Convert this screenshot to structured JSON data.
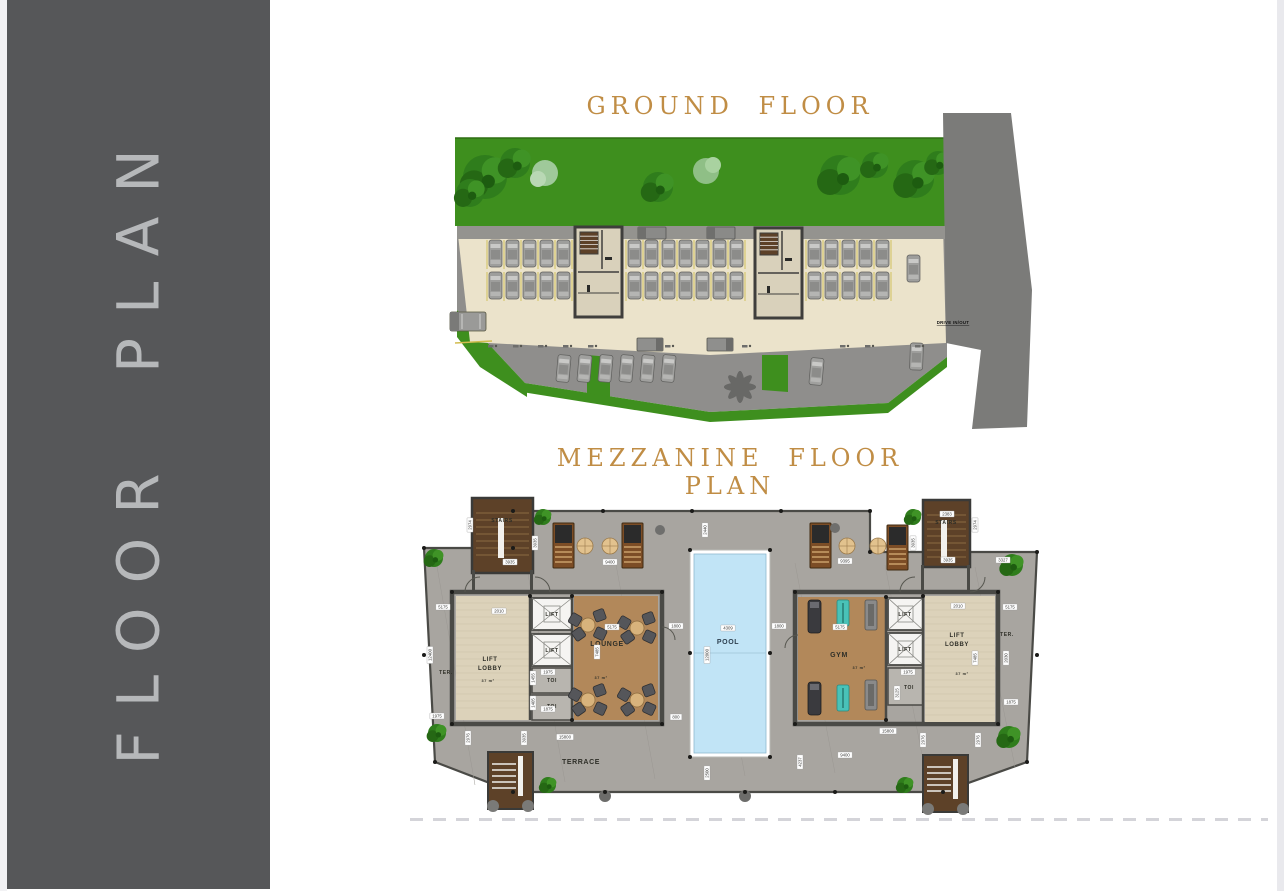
{
  "sidebar": {
    "label": "FLOOR PLAN"
  },
  "titles": {
    "ground": "GROUND FLOOR",
    "mezzanine": "MEZZANINE FLOOR PLAN"
  },
  "colors": {
    "title_accent": "#c08d45",
    "sidebar_bg": "#565759",
    "sidebar_text": "#b6b8ba",
    "grass": "#3e8f1e",
    "road": "#7b7b79",
    "deck": "#a8a5a0",
    "wall": "#4a4a46",
    "pool_water": "#c1e4f6",
    "room_tan": "#b2885a",
    "room_beige": "#dcd2ba",
    "stair_brown": "#5d4128",
    "parking_surface": "#ebe3cb",
    "asphalt": "#8f8e8c",
    "car_body": "#9e9e9c",
    "dim_text": "#3a3a38"
  },
  "ground_floor": {
    "labels": [
      {
        "t": "DRIVE IN/OUT",
        "x": 543,
        "y": 219,
        "s": 4.3
      }
    ]
  },
  "mezzanine": {
    "room_labels": [
      {
        "t": "STAIRS",
        "x": 87,
        "y": 37,
        "s": 5,
        "c": "#2f2f28"
      },
      {
        "t": "STAIRS",
        "x": 531,
        "y": 39,
        "s": 5,
        "c": "#2f2f28"
      },
      {
        "t": "LIFT",
        "x": 137,
        "y": 131,
        "s": 5.2,
        "c": "#2f2f28"
      },
      {
        "t": "LIFT",
        "x": 137,
        "y": 167,
        "s": 5.2,
        "c": "#2f2f28"
      },
      {
        "t": "LIFT",
        "x": 490,
        "y": 131,
        "s": 5.2,
        "c": "#2f2f28"
      },
      {
        "t": "LIFT",
        "x": 490,
        "y": 166,
        "s": 5.2,
        "c": "#2f2f28"
      },
      {
        "t": "LIFT",
        "x": 75,
        "y": 176,
        "s": 6,
        "c": "#2f2f28"
      },
      {
        "t": "LOBBY",
        "x": 75,
        "y": 185,
        "s": 6,
        "c": "#2f2f28"
      },
      {
        "t": "37 m²",
        "x": 73,
        "y": 197,
        "s": 3.8,
        "c": "#2f2f28"
      },
      {
        "t": "LIFT",
        "x": 542,
        "y": 152,
        "s": 6,
        "c": "#2f2f28"
      },
      {
        "t": "LOBBY",
        "x": 542,
        "y": 161,
        "s": 6,
        "c": "#2f2f28"
      },
      {
        "t": "37 m²",
        "x": 547,
        "y": 190,
        "s": 3.8,
        "c": "#2f2f28"
      },
      {
        "t": "LOUNGE",
        "x": 192,
        "y": 161,
        "s": 7,
        "c": "#2f2f28"
      },
      {
        "t": "37 m²",
        "x": 186,
        "y": 194,
        "s": 3.8,
        "c": "#2f2f28"
      },
      {
        "t": "GYM",
        "x": 424,
        "y": 172,
        "s": 7,
        "c": "#2f2f28"
      },
      {
        "t": "37 m²",
        "x": 444,
        "y": 184,
        "s": 3.8,
        "c": "#2f2f28"
      },
      {
        "t": "POOL",
        "x": 313,
        "y": 159,
        "s": 7,
        "c": "#2e4050"
      },
      {
        "t": "TOI",
        "x": 137,
        "y": 197,
        "s": 5,
        "c": "#2f2f28"
      },
      {
        "t": "TOI",
        "x": 137,
        "y": 223,
        "s": 5,
        "c": "#2f2f28"
      },
      {
        "t": "TOI",
        "x": 494,
        "y": 204,
        "s": 5,
        "c": "#2f2f28"
      },
      {
        "t": "TER.",
        "x": 31,
        "y": 189,
        "s": 5,
        "c": "#2f2f28"
      },
      {
        "t": "TER.",
        "x": 592,
        "y": 151,
        "s": 5,
        "c": "#2f2f28"
      },
      {
        "t": "TERRACE",
        "x": 166,
        "y": 279,
        "s": 7,
        "c": "#2f2f28"
      }
    ],
    "dims": [
      [
        "2974",
        55,
        40,
        1
      ],
      [
        "3935",
        95,
        77,
        0
      ],
      [
        "3935",
        120,
        58,
        1
      ],
      [
        "9400",
        195,
        77,
        0
      ],
      [
        "2440",
        290,
        45,
        1
      ],
      [
        "9395",
        430,
        76,
        0
      ],
      [
        "3935",
        498,
        58,
        1
      ],
      [
        "2383",
        532,
        29,
        0
      ],
      [
        "2974",
        560,
        40,
        1
      ],
      [
        "3935",
        533,
        75,
        0
      ],
      [
        "3327",
        588,
        75,
        0
      ],
      [
        "5175",
        28,
        122,
        0
      ],
      [
        "2010",
        84,
        126,
        0
      ],
      [
        "5175",
        197,
        142,
        0
      ],
      [
        "1800",
        261,
        141,
        0
      ],
      [
        "4309",
        313,
        143,
        0
      ],
      [
        "1800",
        364,
        141,
        0
      ],
      [
        "5175",
        425,
        142,
        0
      ],
      [
        "2010",
        543,
        121,
        0
      ],
      [
        "5175",
        595,
        122,
        0
      ],
      [
        "12400",
        15,
        170,
        1
      ],
      [
        "7485",
        182,
        167,
        1
      ],
      [
        "12000",
        292,
        170,
        1
      ],
      [
        "7485",
        560,
        173,
        1
      ],
      [
        "2030",
        591,
        173,
        1
      ],
      [
        "1975",
        133,
        187,
        0
      ],
      [
        "1455",
        118,
        193,
        1
      ],
      [
        "1875",
        133,
        224,
        0
      ],
      [
        "1405",
        118,
        218,
        1
      ],
      [
        "1975",
        493,
        187,
        0
      ],
      [
        "3125",
        482,
        208,
        1
      ],
      [
        "1875",
        596,
        217,
        0
      ],
      [
        "1975",
        22,
        231,
        0
      ],
      [
        "800",
        261,
        232,
        0
      ],
      [
        "2500",
        292,
        288,
        1
      ],
      [
        "15800",
        150,
        252,
        0
      ],
      [
        "15800",
        473,
        246,
        0
      ],
      [
        "2976",
        53,
        253,
        1
      ],
      [
        "3935",
        109,
        253,
        1
      ],
      [
        "2976",
        508,
        255,
        1
      ],
      [
        "2976",
        563,
        255,
        1
      ],
      [
        "9400",
        430,
        270,
        0
      ],
      [
        "4237",
        385,
        277,
        1
      ]
    ]
  }
}
